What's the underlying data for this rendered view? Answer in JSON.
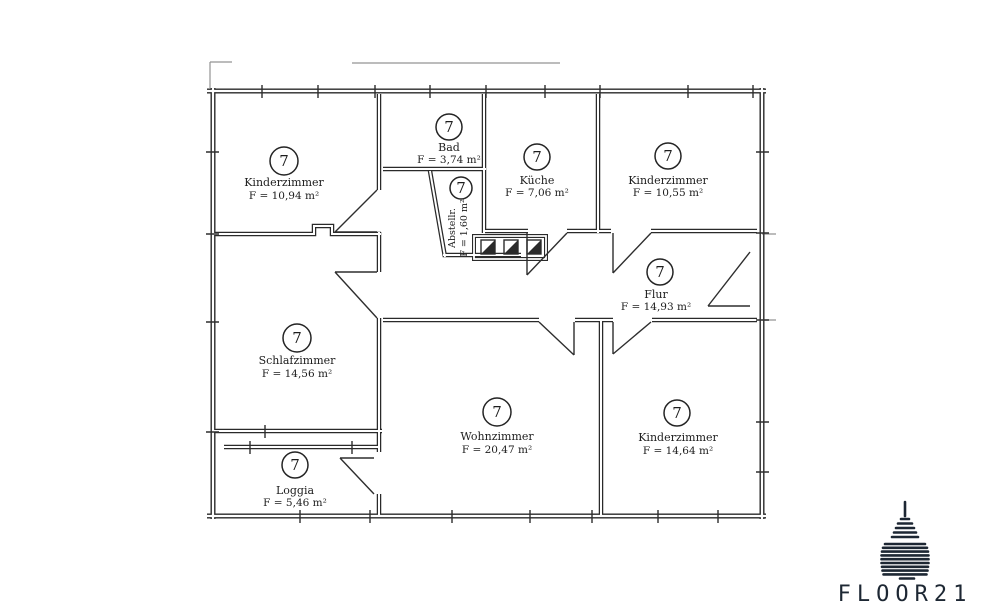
{
  "rooms": [
    {
      "id": "kinderzimmer-tl",
      "badge": "7",
      "name": "Kinderzimmer",
      "area": "F = 10,94 m²"
    },
    {
      "id": "bad",
      "badge": "7",
      "name": "Bad",
      "area": "F = 3,74 m²"
    },
    {
      "id": "abstellraum",
      "badge": "7",
      "name": "Abstellr.",
      "area": "F = 1,60 m²"
    },
    {
      "id": "kueche",
      "badge": "7",
      "name": "Küche",
      "area": "F = 7,06 m²"
    },
    {
      "id": "kinderzimmer-tr",
      "badge": "7",
      "name": "Kinderzimmer",
      "area": "F = 10,55 m²"
    },
    {
      "id": "flur",
      "badge": "7",
      "name": "Flur",
      "area": "F = 14,93 m²"
    },
    {
      "id": "schlafzimmer",
      "badge": "7",
      "name": "Schlafzimmer",
      "area": "F = 14,56 m²"
    },
    {
      "id": "wohnzimmer",
      "badge": "7",
      "name": "Wohnzimmer",
      "area": "F = 20,47 m²"
    },
    {
      "id": "kinderzimmer-br",
      "badge": "7",
      "name": "Kinderzimmer",
      "area": "F = 14,64 m²"
    },
    {
      "id": "loggia",
      "badge": "7",
      "name": "Loggia",
      "area": "F = 5,46 m²"
    }
  ],
  "logo": {
    "wordmark": "FLOOR21",
    "color": "#1d2733"
  }
}
